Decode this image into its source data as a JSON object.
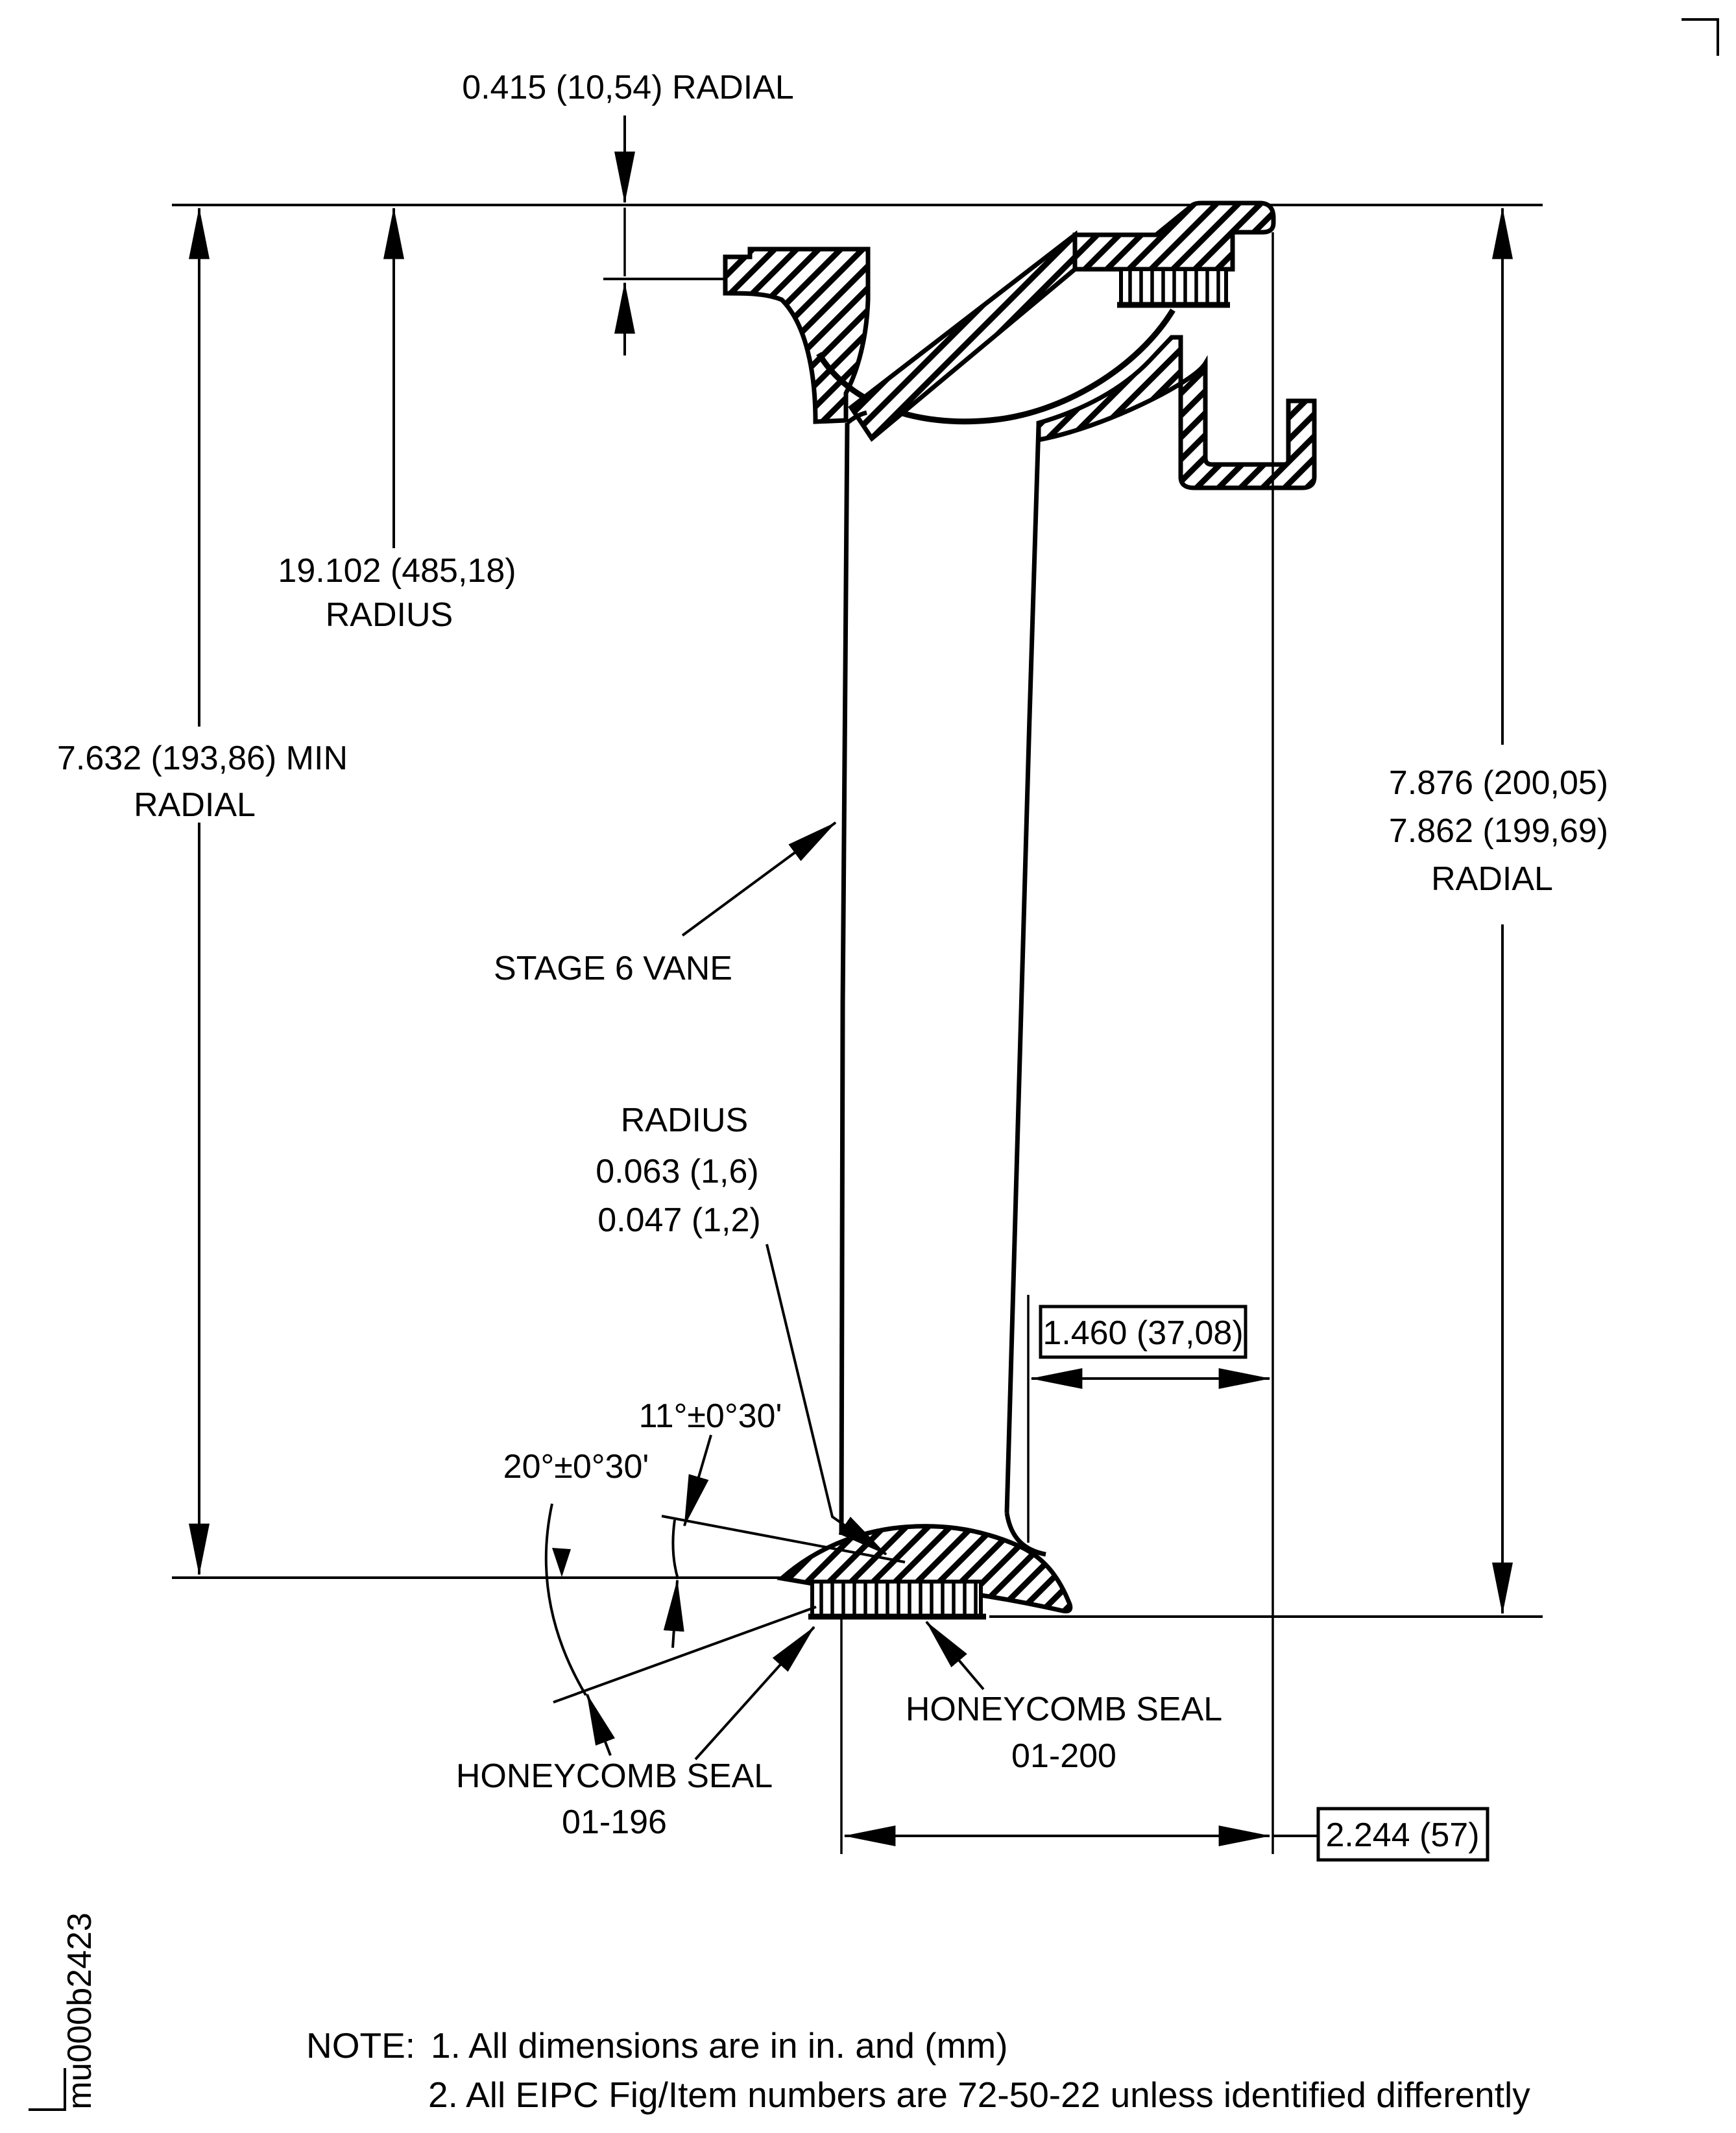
{
  "dims": {
    "d0415": "0.415 (10,54) RADIAL",
    "d19102_1": "19.102 (485,18)",
    "d19102_2": "RADIUS",
    "d7632_1": "7.632 (193,86) MIN",
    "d7632_2": "RADIAL",
    "d7876_1": "7.876 (200,05)",
    "d7876_2": "7.862 (199,69)",
    "d7876_3": "RADIAL",
    "d1460": "1.460 (37,08)",
    "d2244": "2.244 (57)",
    "radius_1": "RADIUS",
    "radius_2": "0.063 (1,6)",
    "radius_3": "0.047 (1,2)",
    "angle11": "11°±0°30'",
    "angle20": "20°±0°30'"
  },
  "parts": {
    "stage6_vane": "STAGE 6 VANE",
    "seal200_1": "HONEYCOMB SEAL",
    "seal200_2": "01-200",
    "seal196_1": "HONEYCOMB SEAL",
    "seal196_2": "01-196"
  },
  "notes": {
    "label": "NOTE:",
    "n1": "1. All dimensions are in in. and (mm)",
    "n2": "2. All EIPC Fig/Item numbers are 72-50-22 unless identified differently"
  },
  "watermark": "mu000b2423",
  "colors": {
    "ink": "#000000",
    "paper": "#ffffff"
  }
}
